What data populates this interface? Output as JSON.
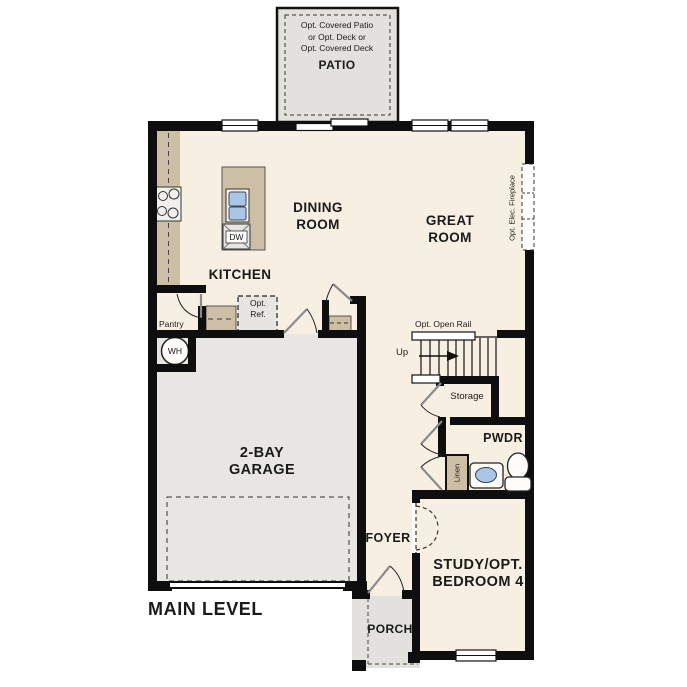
{
  "title": "MAIN LEVEL",
  "colors": {
    "wall": "#0e0e0e",
    "floor": "#f7f0e2",
    "garage_floor": "#e8e6e2",
    "concrete": "#e3e1de",
    "counter": "#cdbfa5",
    "sink_blue": "#a9c6e5"
  },
  "patio": {
    "note1": "Opt. Covered Patio",
    "note2": "or Opt. Deck or",
    "note3": "Opt. Covered Deck",
    "label": "PATIO"
  },
  "rooms": {
    "dining1": "DINING",
    "dining2": "ROOM",
    "great1": "GREAT",
    "great2": "ROOM",
    "kitchen": "KITCHEN",
    "garage1": "2-BAY",
    "garage2": "GARAGE",
    "study1": "STUDY/OPT.",
    "study2": "BEDROOM 4",
    "foyer": "FOYER",
    "pwdr": "PWDR",
    "porch": "PORCH"
  },
  "annotations": {
    "pantry": "Pantry",
    "opt_ref1": "Opt.",
    "opt_ref2": "Ref.",
    "wh": "WH",
    "dw": "DW",
    "fireplace": "Opt. Elec. Fireplace",
    "open_rail": "Opt. Open Rail",
    "up": "Up",
    "storage": "Storage",
    "linen": "Linen"
  }
}
